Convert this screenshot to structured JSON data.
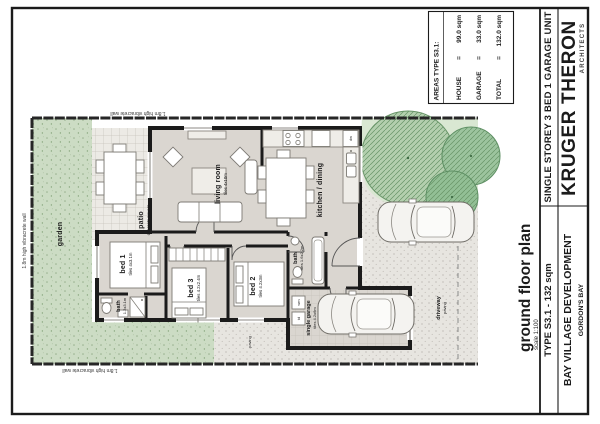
{
  "title_block": {
    "firm_name": "KRUGER THERON",
    "firm_subtitle": "ARCHITECTS",
    "project_type": "SINGLE STOREY 3 BED 1 GARAGE UNIT",
    "type_label": "TYPE S3.1 - 132 sqm",
    "development": "BAY VILLAGE DEVELOPMENT",
    "location": "GORDON'S BAY"
  },
  "areas_table": {
    "header": "AREAS TYPE S3.1:",
    "rows": [
      {
        "label": "HOUSE",
        "eq": "=",
        "value": "99.0 sqm"
      },
      {
        "label": "GARAGE",
        "eq": "=",
        "value": "33.0 sqm"
      },
      {
        "label": "TOTAL",
        "eq": "=",
        "value": "132.0 sqm"
      }
    ]
  },
  "drawing_title": {
    "title": "ground floor plan",
    "scale": "scale 1:100"
  },
  "boundary": {
    "wall_top": "1.8m high vibracrete wall",
    "wall_left": "1.8m high vibracrete wall",
    "wall_bottom": "1.8m high vibracrete wall"
  },
  "rooms": {
    "living": {
      "name": "living room",
      "size": "tiles 4x10m"
    },
    "kitchen": {
      "name": "kitchen / dining"
    },
    "patio": {
      "name": "patio",
      "size": "concrete pavers"
    },
    "bed1": {
      "name": "bed 1",
      "size": "tiles 4x3.1m"
    },
    "bed2": {
      "name": "bed 2",
      "size": "tiles 4.2x3m"
    },
    "bed3": {
      "name": "bed 3",
      "size": "tiles 4.2x2.4m"
    },
    "bath1": {
      "name": "bath",
      "size": "1.2x3.1m"
    },
    "bath2": {
      "name": "bath",
      "size": "tiles 1.6x2.2m"
    },
    "garage": {
      "name": "single garage",
      "size": "tiles 4.2x6m"
    },
    "driveway": {
      "name": "driveway",
      "size": "paving"
    },
    "garden": {
      "name": "garden"
    },
    "paving_strip": {
      "name": "paving"
    }
  },
  "appliances": {
    "dishwasher": "dw",
    "washing_machine": "wm",
    "tumble_dryer": "td"
  },
  "colors": {
    "wall": "#1b1b1b",
    "floor": "#dad6d0",
    "garden": "#ccdcc4",
    "tree_light": "#b3cfae",
    "tree_dark": "#92bf95",
    "paving": "#e7e5e0"
  }
}
